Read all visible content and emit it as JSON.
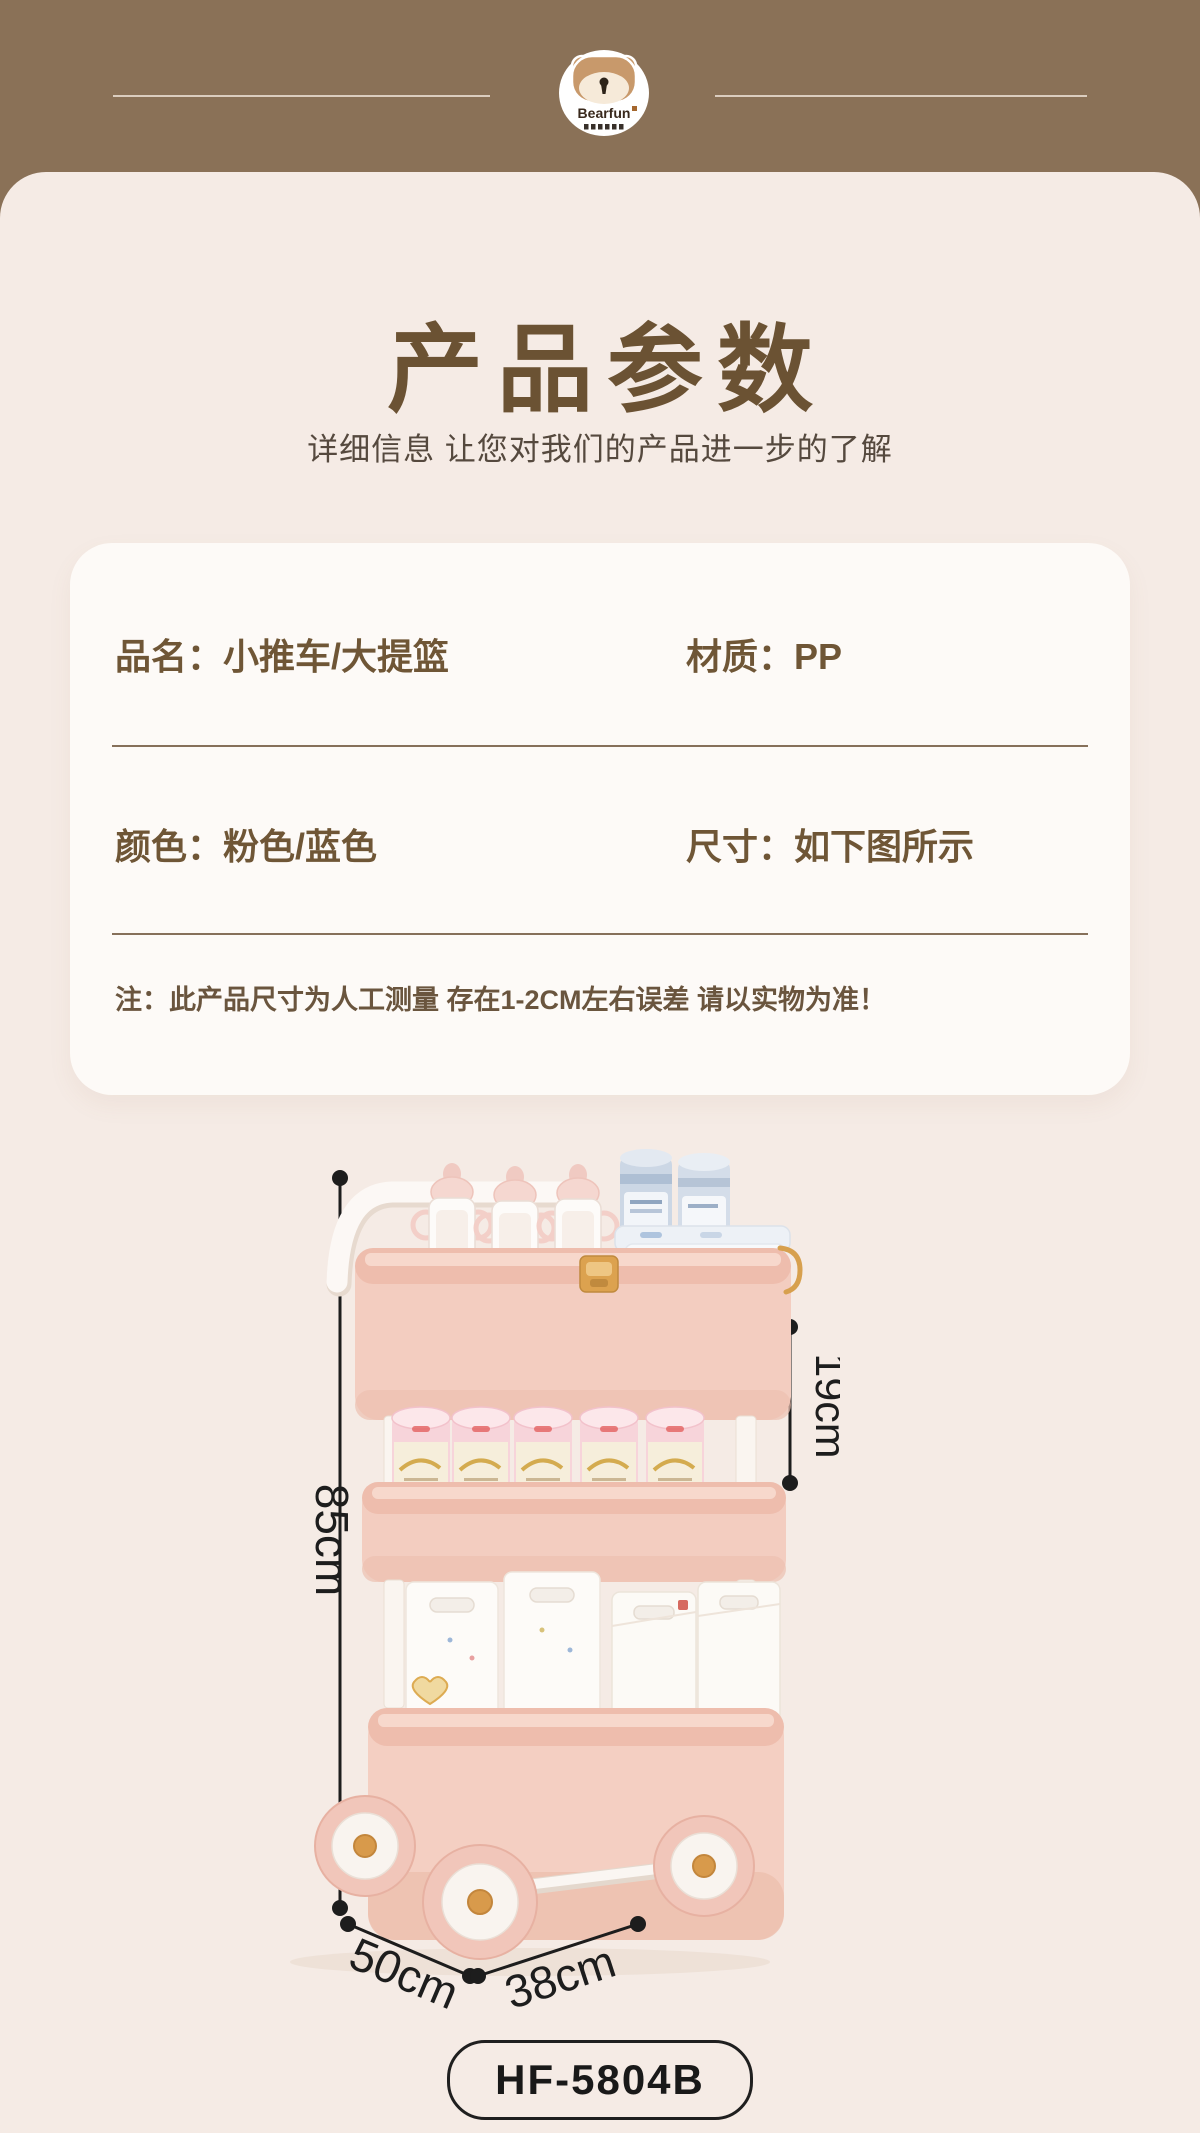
{
  "header": {
    "brand": "Bearfun"
  },
  "intro": {
    "title": "产品参数",
    "subtitle": "详细信息 让您对我们的产品进一步的了解"
  },
  "spec_card": {
    "rows": [
      {
        "left": "品名：小推车/大提篮",
        "right": "材质：PP"
      },
      {
        "left": "颜色：粉色/蓝色",
        "right": "尺寸：如下图所示"
      }
    ],
    "note": "注：此产品尺寸为人工测量 存在1-2CM左右误差 请以实物为准！"
  },
  "diagram": {
    "height": "85cm",
    "tier_gap": "19cm",
    "width": "50cm",
    "depth": "38cm"
  },
  "model_code": "HF-5804B",
  "colors": {
    "header_bg": "#8a7157",
    "page_bg": "#f5ebe5",
    "card_bg": "#fdfaf7",
    "title_text": "#6b5233",
    "spec_text": "#6f5636",
    "divider": "#86705a",
    "dimension_marks": "#1d1d1d",
    "trolley_pink": "#f3cdc0",
    "trolley_rim_pink": "#eebdad",
    "trolley_gold": "#dca24f",
    "pole_white": "#faf5f0"
  }
}
